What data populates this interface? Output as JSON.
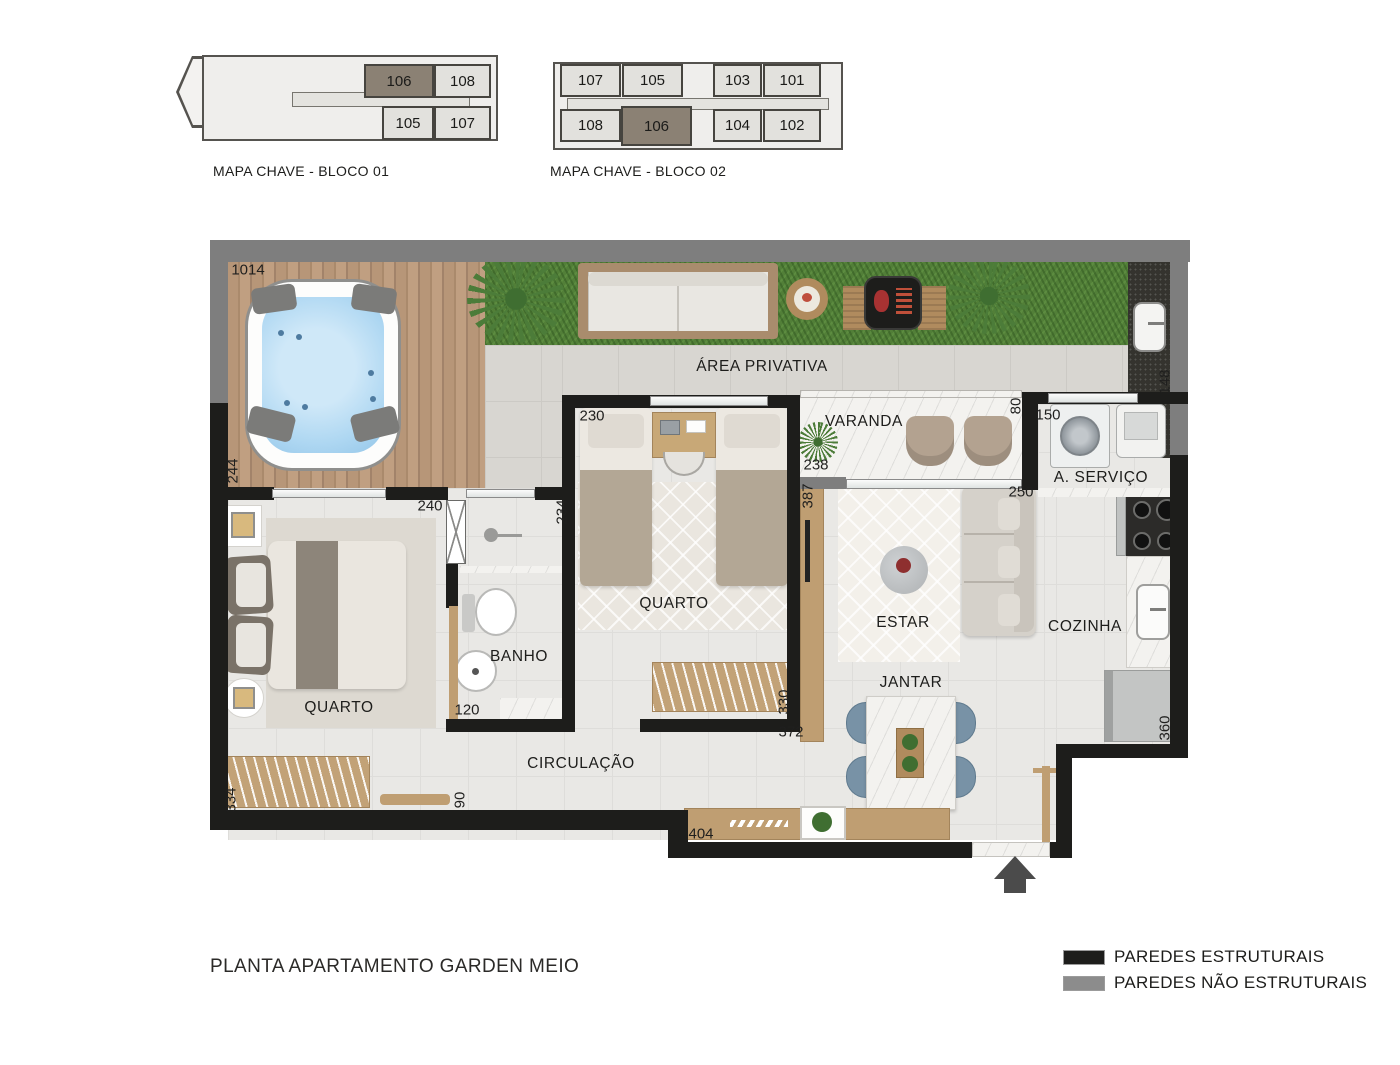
{
  "title": "PLANTA APARTAMENTO GARDEN MEIO",
  "key_maps": [
    {
      "label": "MAPA CHAVE - BLOCO 01",
      "units": [
        {
          "id": "106",
          "highlight": true,
          "x": 364,
          "y": 64,
          "w": 70,
          "h": 34
        },
        {
          "id": "108",
          "highlight": false,
          "x": 434,
          "y": 64,
          "w": 57,
          "h": 34
        },
        {
          "id": "105",
          "highlight": false,
          "x": 382,
          "y": 106,
          "w": 52,
          "h": 34
        },
        {
          "id": "107",
          "highlight": false,
          "x": 434,
          "y": 106,
          "w": 57,
          "h": 34
        }
      ]
    },
    {
      "label": "MAPA CHAVE - BLOCO 02",
      "units": [
        {
          "id": "107",
          "highlight": false,
          "x": 560,
          "y": 64,
          "w": 61,
          "h": 33
        },
        {
          "id": "105",
          "highlight": false,
          "x": 622,
          "y": 64,
          "w": 61,
          "h": 33
        },
        {
          "id": "103",
          "highlight": false,
          "x": 713,
          "y": 64,
          "w": 49,
          "h": 33
        },
        {
          "id": "101",
          "highlight": false,
          "x": 763,
          "y": 64,
          "w": 58,
          "h": 33
        },
        {
          "id": "108",
          "highlight": false,
          "x": 560,
          "y": 109,
          "w": 61,
          "h": 33
        },
        {
          "id": "106",
          "highlight": true,
          "x": 621,
          "y": 106,
          "w": 71,
          "h": 40
        },
        {
          "id": "104",
          "highlight": false,
          "x": 713,
          "y": 109,
          "w": 49,
          "h": 33
        },
        {
          "id": "102",
          "highlight": false,
          "x": 763,
          "y": 109,
          "w": 58,
          "h": 33
        }
      ]
    }
  ],
  "floor_plan": {
    "room_labels": [
      {
        "text": "ÁREA PRIVATIVA",
        "x": 762,
        "y": 367
      },
      {
        "text": "VARANDA",
        "x": 864,
        "y": 422
      },
      {
        "text": "QUARTO",
        "x": 674,
        "y": 604
      },
      {
        "text": "QUARTO",
        "x": 339,
        "y": 708
      },
      {
        "text": "BANHO",
        "x": 519,
        "y": 657
      },
      {
        "text": "CIRCULAÇÃO",
        "x": 581,
        "y": 764
      },
      {
        "text": "ESTAR",
        "x": 903,
        "y": 623
      },
      {
        "text": "JANTAR",
        "x": 911,
        "y": 683
      },
      {
        "text": "COZINHA",
        "x": 1085,
        "y": 627
      },
      {
        "text": "A. SERVIÇO",
        "x": 1101,
        "y": 478
      }
    ],
    "dimensions": [
      {
        "value": "1014",
        "x": 248,
        "y": 270,
        "vertical": false
      },
      {
        "value": "244",
        "x": 233,
        "y": 471,
        "vertical": true
      },
      {
        "value": "240",
        "x": 430,
        "y": 506,
        "vertical": false
      },
      {
        "value": "234",
        "x": 562,
        "y": 512,
        "vertical": true
      },
      {
        "value": "230",
        "x": 592,
        "y": 416,
        "vertical": false
      },
      {
        "value": "238",
        "x": 816,
        "y": 465,
        "vertical": false
      },
      {
        "value": "387",
        "x": 808,
        "y": 496,
        "vertical": true
      },
      {
        "value": "80",
        "x": 1016,
        "y": 406,
        "vertical": true
      },
      {
        "value": "150",
        "x": 1048,
        "y": 415,
        "vertical": false
      },
      {
        "value": "148",
        "x": 1165,
        "y": 382,
        "vertical": true
      },
      {
        "value": "250",
        "x": 1021,
        "y": 492,
        "vertical": false
      },
      {
        "value": "120",
        "x": 467,
        "y": 710,
        "vertical": false
      },
      {
        "value": "330",
        "x": 784,
        "y": 702,
        "vertical": true
      },
      {
        "value": "372",
        "x": 791,
        "y": 732,
        "vertical": false
      },
      {
        "value": "90",
        "x": 460,
        "y": 800,
        "vertical": true
      },
      {
        "value": "334",
        "x": 231,
        "y": 800,
        "vertical": true
      },
      {
        "value": "404",
        "x": 701,
        "y": 834,
        "vertical": false
      },
      {
        "value": "360",
        "x": 1165,
        "y": 728,
        "vertical": true
      }
    ]
  },
  "legend": [
    {
      "label": "PAREDES ESTRUTURAIS",
      "color": "#1d1d1b"
    },
    {
      "label": "PAREDES NÃO ESTRUTURAIS",
      "color": "#8c8c8c"
    }
  ],
  "colors": {
    "structural_wall": "#1d1d1b",
    "non_structural_wall": "#7e7e7e",
    "highlight_unit": "#8b8174",
    "grass": "#527f38",
    "deck_wood": "#b29175",
    "water": "#aed7f2"
  }
}
